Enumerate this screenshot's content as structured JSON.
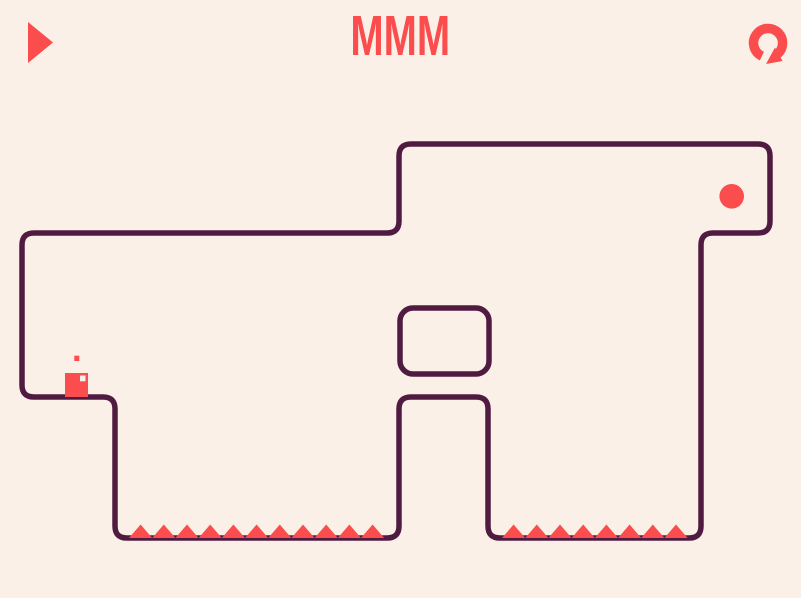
{
  "app": {
    "title": "MMM"
  },
  "header": {
    "play_button": {
      "icon": "play-triangle",
      "aria": "play"
    },
    "restart_button": {
      "icon": "restart-arrow",
      "aria": "restart level"
    }
  },
  "colors": {
    "background": "#faf0e8",
    "accent": "#fb4d4d",
    "wall": "#501b40",
    "player_eye": "#faf0e8"
  },
  "level": {
    "player": {
      "x": 65,
      "y": 373,
      "width": 23,
      "height": 24
    },
    "player_eye": {
      "x": 80,
      "y": 375.5,
      "width": 5.5,
      "height": 5.8
    },
    "player_dot": {
      "x": 74.3,
      "y": 355.7,
      "width": 5,
      "height": 5.3
    },
    "goal_dot": {
      "cx": 731.7,
      "cy": 196.3,
      "r": 12.3
    },
    "spike_rows": [
      {
        "name": "left-floor-spikes",
        "start_x": 129,
        "count": 11,
        "spike_width": 23.2,
        "spike_height": 13.5,
        "base_y": 538
      },
      {
        "name": "right-floor-spikes",
        "start_x": 502,
        "count": 8,
        "spike_width": 23.2,
        "spike_height": 13.5,
        "base_y": 538
      }
    ]
  }
}
